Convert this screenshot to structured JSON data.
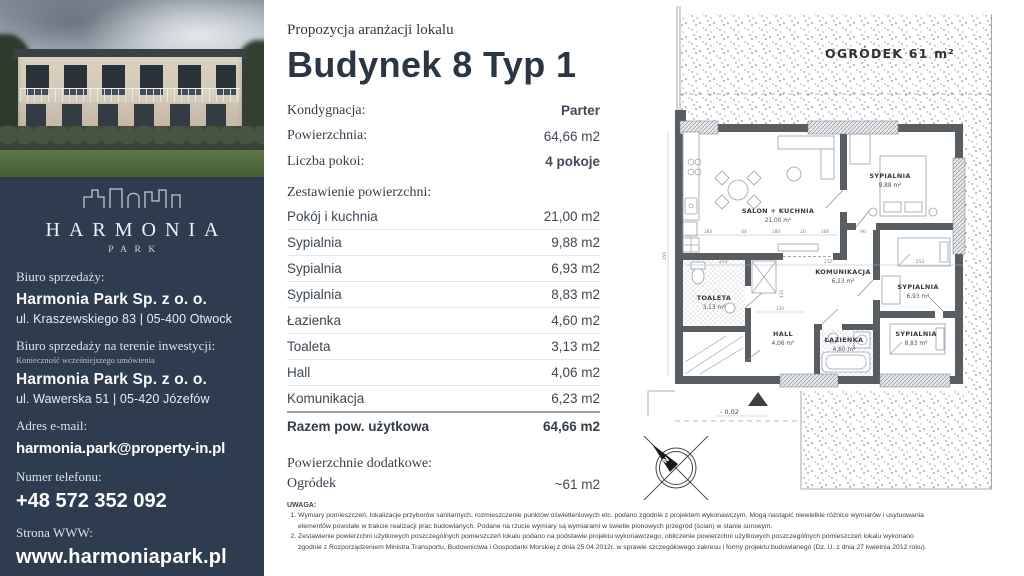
{
  "sidebar": {
    "brand": {
      "name": "HARMONIA",
      "sub": "PARK"
    },
    "office_label": "Biuro sprzedaży:",
    "office_company": "Harmonia Park Sp. z o. o.",
    "office_address": "ul. Kraszewskiego 83 | 05-400 Otwock",
    "site_office_label": "Biuro sprzedaży na terenie inwestycji:",
    "site_office_note": "Konieczność wcześniejszego umówienia",
    "site_office_company": "Harmonia Park Sp. z o. o.",
    "site_office_address": "ul. Wawerska 51 | 05-420 Józefów",
    "email_label": "Adres e-mail:",
    "email": "harmonia.park@property-in.pl",
    "phone_label": "Numer telefonu:",
    "phone": "+48 572 352 092",
    "www_label": "Strona WWW:",
    "www": "www.harmoniapark.pl"
  },
  "header": {
    "kicker": "Propozycja aranżacji lokalu",
    "title": "Budynek 8 Typ 1"
  },
  "summary": {
    "rows": [
      {
        "label": "Kondygnacja:",
        "value": "Parter"
      },
      {
        "label": "Powierzchnia:",
        "value": "64,66 m2"
      },
      {
        "label": "Liczba pokoi:",
        "value": "4 pokoje"
      }
    ]
  },
  "areas": {
    "heading": "Zestawienie powierzchni:",
    "rows": [
      {
        "name": "Pokój i kuchnia",
        "value": "21,00 m2"
      },
      {
        "name": "Sypialnia",
        "value": "9,88 m2"
      },
      {
        "name": "Sypialnia",
        "value": "6,93 m2"
      },
      {
        "name": "Sypialnia",
        "value": "8,83 m2"
      },
      {
        "name": "Łazienka",
        "value": "4,60 m2"
      },
      {
        "name": "Toaleta",
        "value": "3,13 m2"
      },
      {
        "name": "Hall",
        "value": "4,06 m2"
      },
      {
        "name": "Komunikacja",
        "value": "6,23 m2"
      }
    ],
    "total_label": "Razem pow. użytkowa",
    "total_value": "64,66 m2",
    "extra_heading": "Powierzchnie dodatkowe:",
    "extra_name": "Ogródek",
    "extra_value": "~61 m2"
  },
  "notes": {
    "heading": "UWAGA:",
    "items": [
      "Wymiary pomieszczeń, lokalizacje przyborów sanitarnych, rozmieszczenie punktów oświetleniowych etc. podano zgodnie z projektem wykonawczym. Mogą nastąpić niewielkie różnice wymiarów i usytuowania elementów powstałe w trakcie realizacji prac budowlanych. Podane na rzucie wymiary są wymiarami w świetle pionowych przegród (ścian) w stanie surowym.",
      "Zestawienie powierzchni użytkowych poszczególnych pomieszczeń lokalu podano na podstawie projektu wykonawczego; obliczenie powierzchni użytkowych poszczególnych pomieszczeń lokalu wykonano zgodnie z Rozporządzeniem Ministra Transportu, Budownictwa i Gospodarki Morskiej z dnia 25.04.2012r. w sprawie szczegółowego zakresu i formy projektu budowlanego (Dz. U. z dnia 27 kwietnia 2012 roku)."
    ]
  },
  "plan": {
    "garden_label": "OGRÓDEK 61 m²",
    "rooms": [
      {
        "name": "SALON + KUCHNIA",
        "area": "21,00 m²"
      },
      {
        "name": "SYPIALNIA",
        "area": "9,88 m²"
      },
      {
        "name": "KOMUNIKACJA",
        "area": "6,23 m²"
      },
      {
        "name": "SYPIALNIA",
        "area": "6,93 m²"
      },
      {
        "name": "TOALETA",
        "area": "3,13 m²"
      },
      {
        "name": "HALL",
        "area": "4,06 m²"
      },
      {
        "name": "ŁAZIENKA",
        "area": "4,60 m²"
      },
      {
        "name": "SYPIALNIA",
        "area": "8,83 m²"
      }
    ],
    "dims": [
      "183",
      "44",
      "180",
      "20",
      "100",
      "90",
      "254",
      "112",
      "253",
      "120",
      "135",
      "150"
    ],
    "level_marker": "- 0,02",
    "compass_letter": "N"
  },
  "colors": {
    "sidebar_bg": "#2d3c4e",
    "title_text": "#2b3644",
    "wall": "#585d62"
  }
}
